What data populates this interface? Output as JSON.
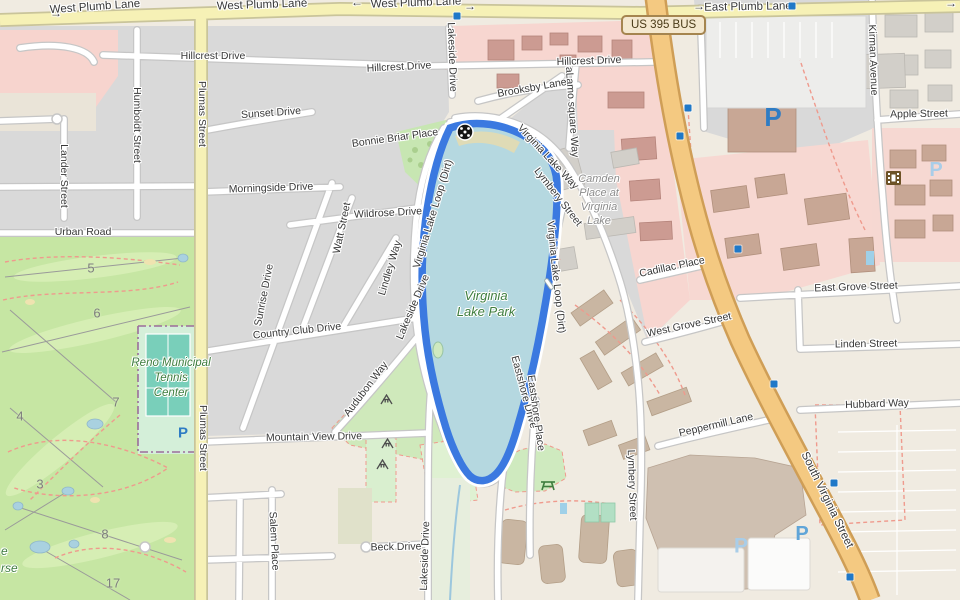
{
  "map": {
    "title": "Virginia Lake Park area map",
    "shield": {
      "text": "US 395 BUS"
    },
    "route": {
      "name": "Virginia Lake Loop (Dirt)",
      "color": "#3b79e0"
    },
    "colors": {
      "water": "#b5d8e0",
      "route": "#3b79e0",
      "golf": "#c6e6a3",
      "urban_gray": "#d9d9d9",
      "retail_pink": "#f7d6d0",
      "road_yellow": "#f6f1b6",
      "road_orange": "#f4c981",
      "park_label_green": "#3e7d3e",
      "parking_blue": "#2e7cc4"
    },
    "street_labels": [
      {
        "t": "West Plumb Lane",
        "x": 95,
        "y": 7,
        "r": -4,
        "cls": "big"
      },
      {
        "t": "West Plumb Lane",
        "x": 262,
        "y": 5,
        "r": -2,
        "cls": "big"
      },
      {
        "t": "West Plumb Lane",
        "x": 416,
        "y": 3,
        "r": -2,
        "cls": "big"
      },
      {
        "t": "East Plumb Lane",
        "x": 748,
        "y": 7,
        "r": -1,
        "cls": "big"
      },
      {
        "t": "→",
        "x": 56,
        "y": 13,
        "r": 0,
        "cls": "ar"
      },
      {
        "t": "←",
        "x": 357,
        "y": 2,
        "r": 0,
        "cls": "ar"
      },
      {
        "t": "→",
        "x": 470,
        "y": 6,
        "r": 0,
        "cls": "ar"
      },
      {
        "t": "→",
        "x": 699,
        "y": 6,
        "r": 0,
        "cls": "ar"
      },
      {
        "t": "→",
        "x": 951,
        "y": 3,
        "r": 0,
        "cls": "ar"
      },
      {
        "t": "Hillcrest Drive",
        "x": 213,
        "y": 56,
        "r": 0
      },
      {
        "t": "Hillcrest Drive",
        "x": 399,
        "y": 67,
        "r": -3
      },
      {
        "t": "Hillcrest Drive",
        "x": 589,
        "y": 61,
        "r": -2
      },
      {
        "t": "Sunset Drive",
        "x": 271,
        "y": 113,
        "r": -4
      },
      {
        "t": "Morningside Drive",
        "x": 271,
        "y": 188,
        "r": -2
      },
      {
        "t": "Urban Road",
        "x": 83,
        "y": 232,
        "r": 0
      },
      {
        "t": "Wildrose Drive",
        "x": 388,
        "y": 213,
        "r": -3
      },
      {
        "t": "Humboldt Street",
        "x": 137,
        "y": 125,
        "r": 90
      },
      {
        "t": "Lander Street",
        "x": 64,
        "y": 176,
        "r": 90
      },
      {
        "t": "Plumas Street",
        "x": 202,
        "y": 114,
        "r": 90
      },
      {
        "t": "Plumas Street",
        "x": 203,
        "y": 438,
        "r": 90
      },
      {
        "t": "Watt Street",
        "x": 342,
        "y": 228,
        "r": -78
      },
      {
        "t": "Lindley Way",
        "x": 390,
        "y": 268,
        "r": -73
      },
      {
        "t": "Sunrise Drive",
        "x": 264,
        "y": 295,
        "r": -79
      },
      {
        "t": "Country Club Drive",
        "x": 297,
        "y": 331,
        "r": -6
      },
      {
        "t": "Bonnie Briar Place",
        "x": 395,
        "y": 138,
        "r": -8
      },
      {
        "t": "Lakeside Drive",
        "x": 452,
        "y": 57,
        "r": 88
      },
      {
        "t": "Lakeside Drive",
        "x": 413,
        "y": 307,
        "r": -67
      },
      {
        "t": "Virginia Lake Loop (Dirt)",
        "x": 433,
        "y": 214,
        "r": -73
      },
      {
        "t": "Virginia Lake Loop (Dirt)",
        "x": 556,
        "y": 277,
        "r": 84
      },
      {
        "t": "Virginia Lake Way",
        "x": 548,
        "y": 157,
        "r": 47
      },
      {
        "t": "Lymbery Street",
        "x": 558,
        "y": 197,
        "r": 52
      },
      {
        "t": "Lymbery Street",
        "x": 632,
        "y": 485,
        "r": 88
      },
      {
        "t": "aLamo square Way",
        "x": 572,
        "y": 112,
        "r": 86
      },
      {
        "t": "Brooksby Lane",
        "x": 532,
        "y": 88,
        "r": -10
      },
      {
        "t": "Cadillac Place",
        "x": 672,
        "y": 267,
        "r": -12
      },
      {
        "t": "West Grove Street",
        "x": 689,
        "y": 325,
        "r": -12
      },
      {
        "t": "East Grove Street",
        "x": 856,
        "y": 287,
        "r": -2
      },
      {
        "t": "Linden Street",
        "x": 866,
        "y": 344,
        "r": -1
      },
      {
        "t": "Hubbard Way",
        "x": 877,
        "y": 404,
        "r": -2
      },
      {
        "t": "Peppermill Lane",
        "x": 716,
        "y": 425,
        "r": -13
      },
      {
        "t": "Apple Street",
        "x": 919,
        "y": 114,
        "r": -1
      },
      {
        "t": "Kirman Avenue",
        "x": 873,
        "y": 60,
        "r": 88
      },
      {
        "t": "South Virginia Street",
        "x": 827,
        "y": 500,
        "r": 64,
        "cls": "big"
      },
      {
        "t": "Mountain View Drive",
        "x": 314,
        "y": 437,
        "r": -1
      },
      {
        "t": "Beck Drive",
        "x": 396,
        "y": 547,
        "r": -1
      },
      {
        "t": "Salem Place",
        "x": 274,
        "y": 541,
        "r": 87
      },
      {
        "t": "Lakeside Drive",
        "x": 425,
        "y": 556,
        "r": -88
      },
      {
        "t": "Audubon Way",
        "x": 366,
        "y": 389,
        "r": -53
      },
      {
        "t": "Eastshore Drive",
        "x": 524,
        "y": 392,
        "r": 75
      },
      {
        "t": "Eastshore Place",
        "x": 536,
        "y": 413,
        "r": 82
      }
    ],
    "area_labels": [
      {
        "lines": [
          "Virginia",
          "Lake Park"
        ],
        "x": 486,
        "y": 288,
        "color": "#3e7d3e",
        "size": 13,
        "lh": 16
      },
      {
        "lines": [
          "Camden",
          "Place at",
          "Virginia",
          "Lake"
        ],
        "x": 599,
        "y": 172,
        "color": "#8b8b8b",
        "size": 11,
        "lh": 14
      },
      {
        "lines": [
          "Reno Municipal",
          "Tennis",
          "Center"
        ],
        "x": 171,
        "y": 356,
        "color": "#3e7d3e",
        "size": 11.5,
        "lh": 15
      },
      {
        "lines": [
          "e",
          "rse"
        ],
        "x": 1,
        "y": 543,
        "color": "#3e7d3e",
        "size": 12,
        "lh": 17,
        "cls": "frag"
      }
    ],
    "golf_holes": [
      {
        "n": "3",
        "x": 40,
        "y": 484
      },
      {
        "n": "4",
        "x": 20,
        "y": 416
      },
      {
        "n": "5",
        "x": 91,
        "y": 268
      },
      {
        "n": "6",
        "x": 97,
        "y": 313
      },
      {
        "n": "7",
        "x": 116,
        "y": 402
      },
      {
        "n": "8",
        "x": 105,
        "y": 534
      },
      {
        "n": "17",
        "x": 113,
        "y": 583
      }
    ],
    "icons": {
      "traffic_signals": [
        [
          457,
          16
        ],
        [
          792,
          6
        ],
        [
          688,
          108
        ],
        [
          680,
          136
        ],
        [
          738,
          249
        ],
        [
          774,
          384
        ],
        [
          834,
          483
        ],
        [
          850,
          577
        ]
      ],
      "parking": [
        {
          "x": 773,
          "y": 117,
          "s": 26,
          "c": "#2e7cc4"
        },
        {
          "x": 936,
          "y": 170,
          "s": 20,
          "c": "#a9cde8"
        },
        {
          "x": 183,
          "y": 433,
          "s": 15,
          "c": "#2e7cc4"
        },
        {
          "x": 741,
          "y": 546,
          "s": 21,
          "c": "#a9cde8"
        },
        {
          "x": 802,
          "y": 534,
          "s": 20,
          "c": "#60a5d8"
        }
      ],
      "cinema": {
        "x": 886,
        "y": 171
      },
      "picnic": {
        "x": 540,
        "y": 478
      },
      "playgrounds": [
        [
          380,
          394
        ],
        [
          381,
          438
        ],
        [
          376,
          459
        ]
      ],
      "route_marker": {
        "x": 455,
        "y": 122
      },
      "pier": {
        "x": 542,
        "y": 277
      }
    }
  }
}
